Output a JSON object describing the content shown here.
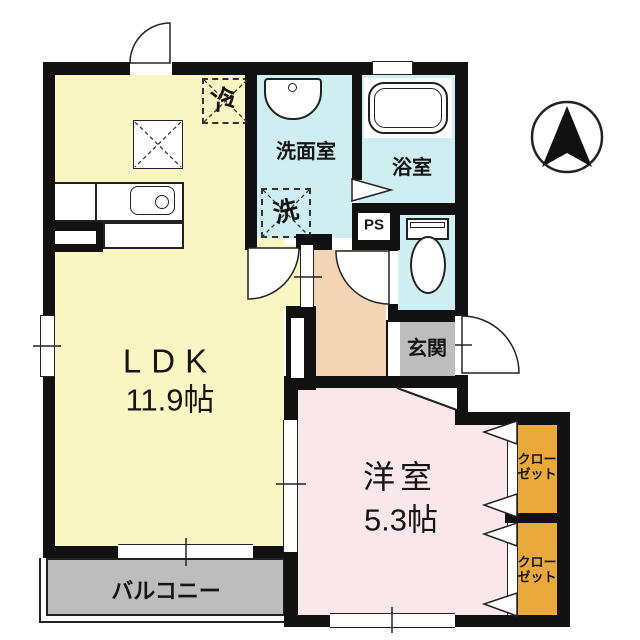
{
  "floor_plan": {
    "rooms": {
      "ldk": {
        "label": "LDK",
        "size": "11.9帖"
      },
      "western_room": {
        "label": "洋室",
        "size": "5.3帖"
      },
      "washroom": {
        "label": "洗面室"
      },
      "bathroom": {
        "label": "浴室"
      },
      "entrance": {
        "label": "玄関"
      },
      "balcony": {
        "label": "バルコニー"
      },
      "pipe_space": {
        "label": "PS"
      },
      "closet_upper": {
        "label_line1": "クロー",
        "label_line2": "ゼット"
      },
      "closet_lower": {
        "label_line1": "クロー",
        "label_line2": "ゼット"
      }
    },
    "fixtures": {
      "refrigerator": {
        "label": "冷"
      },
      "washing_machine": {
        "label": "洗"
      }
    },
    "colors": {
      "ldk_fill": "#F9F6C3",
      "wet_area_fill": "#CFEEF1",
      "hallway_fill": "#F3D4B5",
      "western_room_fill": "#FAE7EA",
      "entrance_fill": "#BDBDBD",
      "balcony_fill": "#BDBDBD",
      "closet_fill": "#E9A93B",
      "wall": "#111111"
    }
  }
}
